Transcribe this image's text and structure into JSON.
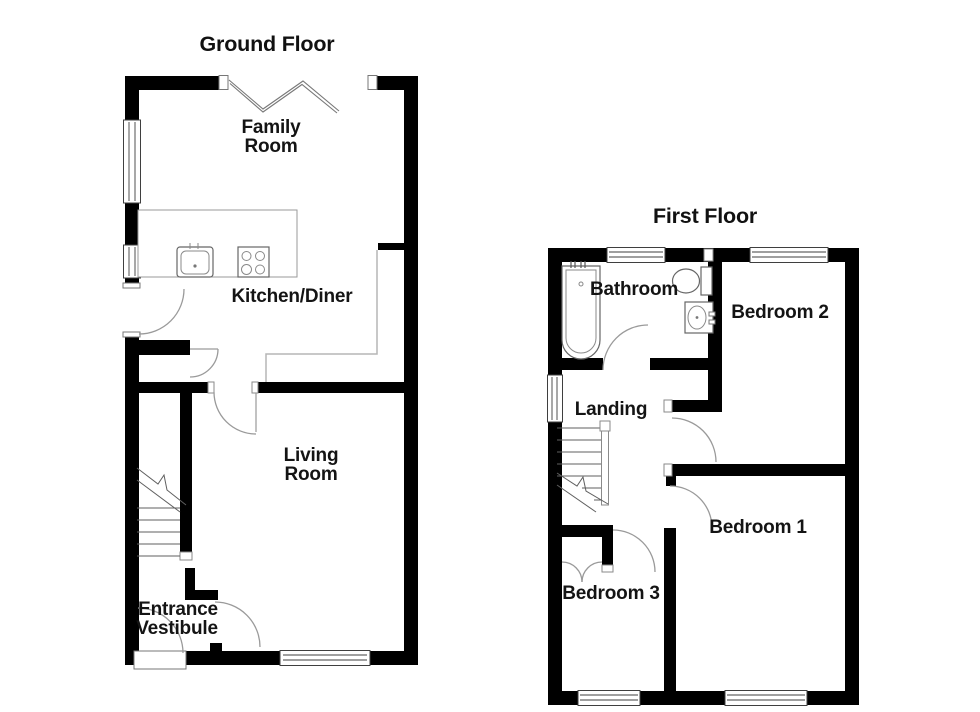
{
  "document": {
    "type": "floorplan",
    "background": "#ffffff"
  },
  "ground_floor": {
    "title": "Ground Floor",
    "rooms": {
      "family_room": {
        "line1": "Family",
        "line2": "Room"
      },
      "kitchen_diner": {
        "label": "Kitchen/Diner"
      },
      "living_room": {
        "line1": "Living",
        "line2": "Room"
      },
      "entrance_vestibule": {
        "line1": "Entrance",
        "line2": "Vestibule"
      }
    },
    "features": [
      "bifold-doors",
      "kitchen-counter",
      "sink",
      "hob",
      "staircase",
      "side-door",
      "front-door"
    ]
  },
  "first_floor": {
    "title": "First Floor",
    "rooms": {
      "bathroom": {
        "label": "Bathroom"
      },
      "bedroom2": {
        "label": "Bedroom 2"
      },
      "landing": {
        "label": "Landing"
      },
      "bedroom1": {
        "label": "Bedroom 1"
      },
      "bedroom3": {
        "label": "Bedroom 3"
      }
    },
    "features": [
      "bath",
      "toilet",
      "basin",
      "staircase",
      "cupboard-double-doors"
    ]
  },
  "colors": {
    "wall": "#000000",
    "background": "#ffffff",
    "door_arc": "#9a9a9a",
    "window_line": "#3f3f3f",
    "fixture_line": "#666666",
    "zone_line": "#b5b5b5",
    "text": "#141414"
  }
}
